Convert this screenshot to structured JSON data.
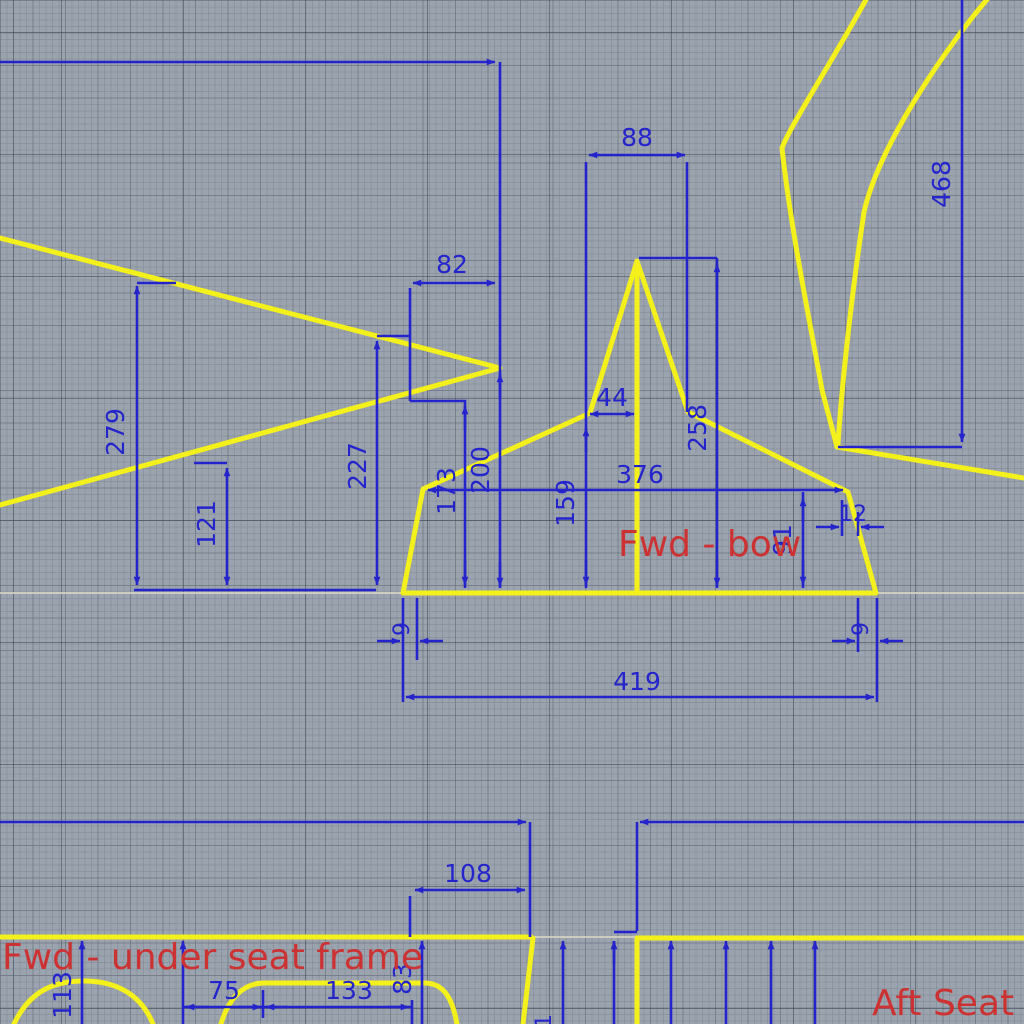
{
  "labels": {
    "fwd_bow": "Fwd - bow",
    "fwd_under_seat_frame": "Fwd - under seat frame",
    "aft_seat": "Aft Seat"
  },
  "dims": {
    "d88": "88",
    "d82": "82",
    "d44": "44",
    "d279": "279",
    "d121": "121",
    "d227": "227",
    "d173": "173",
    "d200": "200",
    "d159": "159",
    "d376": "376",
    "d258": "258",
    "d468": "468",
    "d91": "91",
    "d12": "12",
    "d9_left": "9",
    "d9_right": "9",
    "d419": "419",
    "d108": "108",
    "d113": "113",
    "d75": "75",
    "d133": "133",
    "d83": "83",
    "d1_partial": "1"
  },
  "colors": {
    "background_gray": "#9ba3ae",
    "dimension_blue": "#2424cc",
    "outline_yellow": "#f3f01c",
    "label_red": "#cd3232",
    "reference_line": "#d8d5c4"
  }
}
